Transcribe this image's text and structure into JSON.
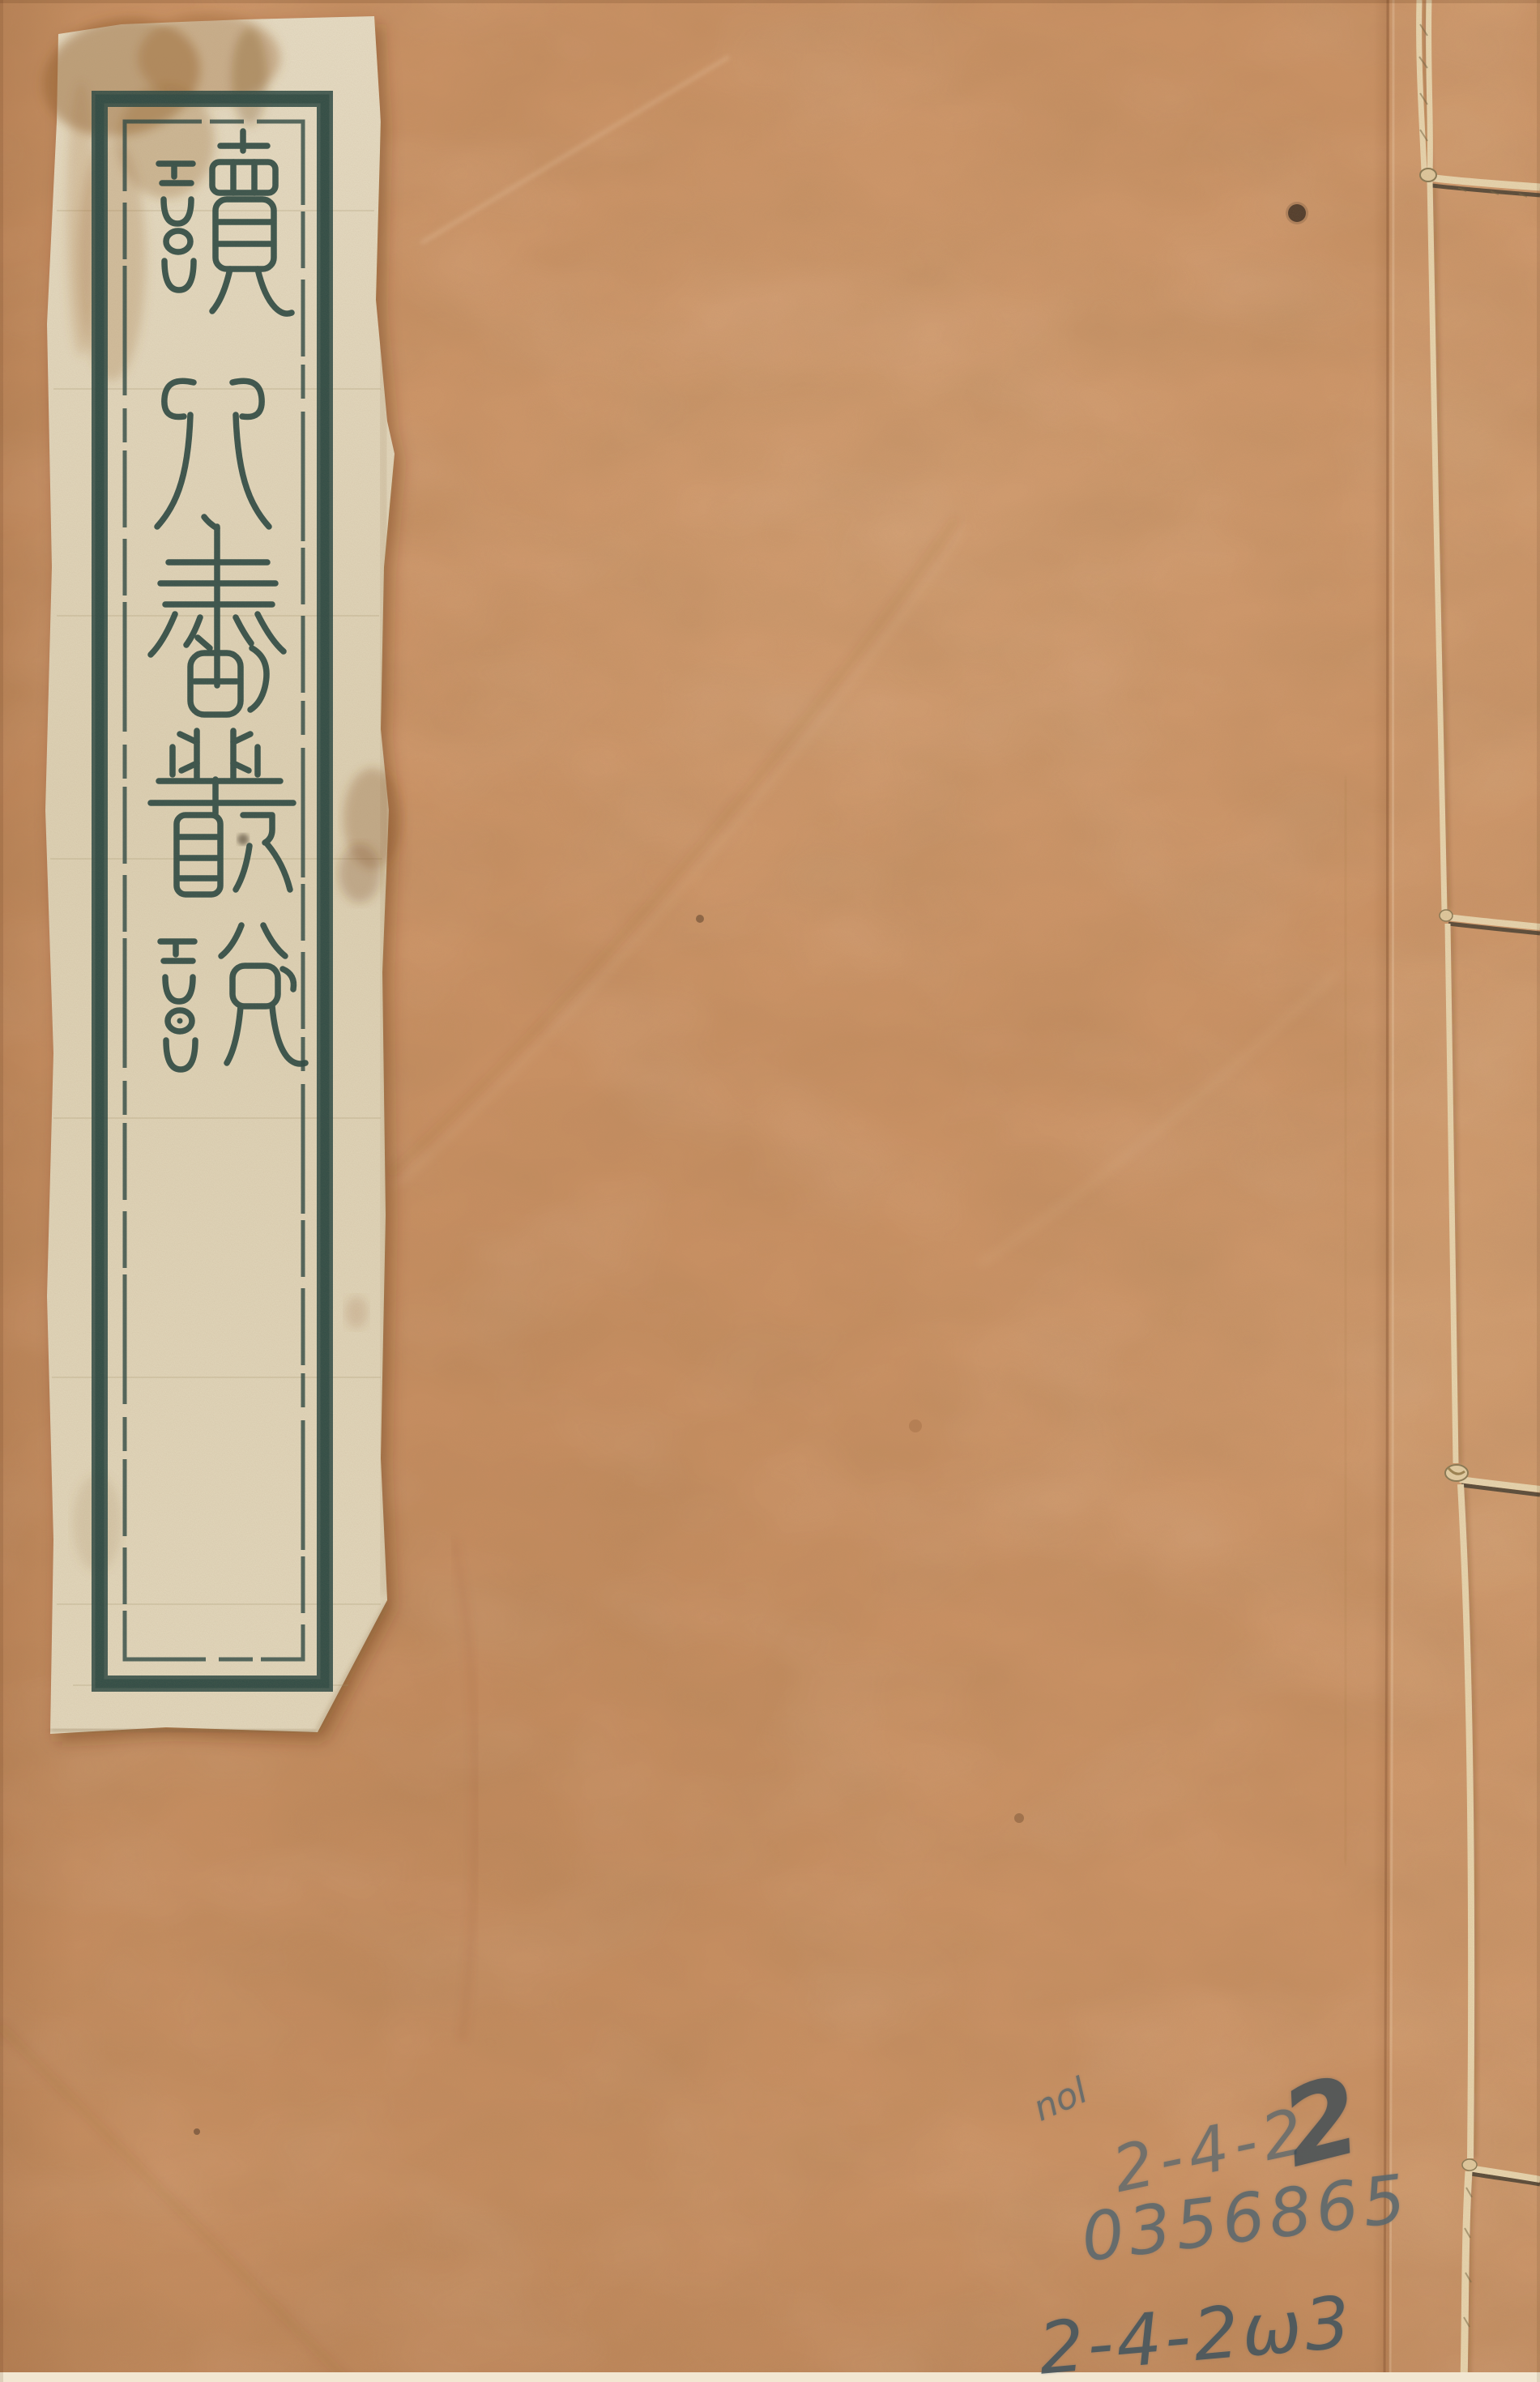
{
  "document": {
    "kind": "thread-bound Chinese book front cover (scan)",
    "cover_color": "#cb9264"
  },
  "title_label": {
    "title": "讀北書叢說",
    "characters": [
      "讀",
      "北",
      "書",
      "叢",
      "說"
    ],
    "script": "seal script, vertical top-to-bottom",
    "paper_color": "#ded2b4",
    "ink_color": "#2f4b45"
  },
  "binding": {
    "edge": "right",
    "hole_count": 4,
    "thread_color": "#e7d4ad"
  },
  "annotations": {
    "pencil_color": "#5b6b73",
    "note_small": "nol",
    "shelf_mark_top": "2-4-2",
    "shelf_mark_overwrite": "2",
    "accession_number": "0356865",
    "shelf_mark_bottom": "2-4-2ω3"
  }
}
